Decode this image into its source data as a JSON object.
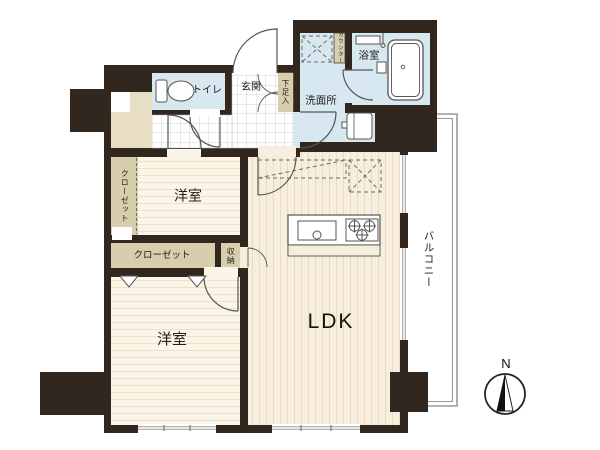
{
  "plan": {
    "type": "apartment-floor-plan",
    "labels": {
      "toilet": "トイレ",
      "entrance": "玄関",
      "shoe_cabinet": "下足入",
      "washroom": "洗面所",
      "bathroom": "浴室",
      "counter": "カウンター",
      "closet_upper": "クローゼット",
      "bedroom_upper": "洋室",
      "closet_lower": "クローゼット",
      "storage": "収納",
      "bedroom_lower": "洋室",
      "ldk": "LDK",
      "balcony": "バルコニー",
      "compass_north": "N"
    },
    "colors": {
      "wall": "#31271f",
      "wet_room_floor": "#d8e8f1",
      "bedroom_floor": "#faf5e6",
      "ldk_floor": "#f7eedd",
      "closet_fill": "#d7cead",
      "utility_fill": "#e8dec3",
      "balcony_line": "#9a9a9a"
    }
  }
}
